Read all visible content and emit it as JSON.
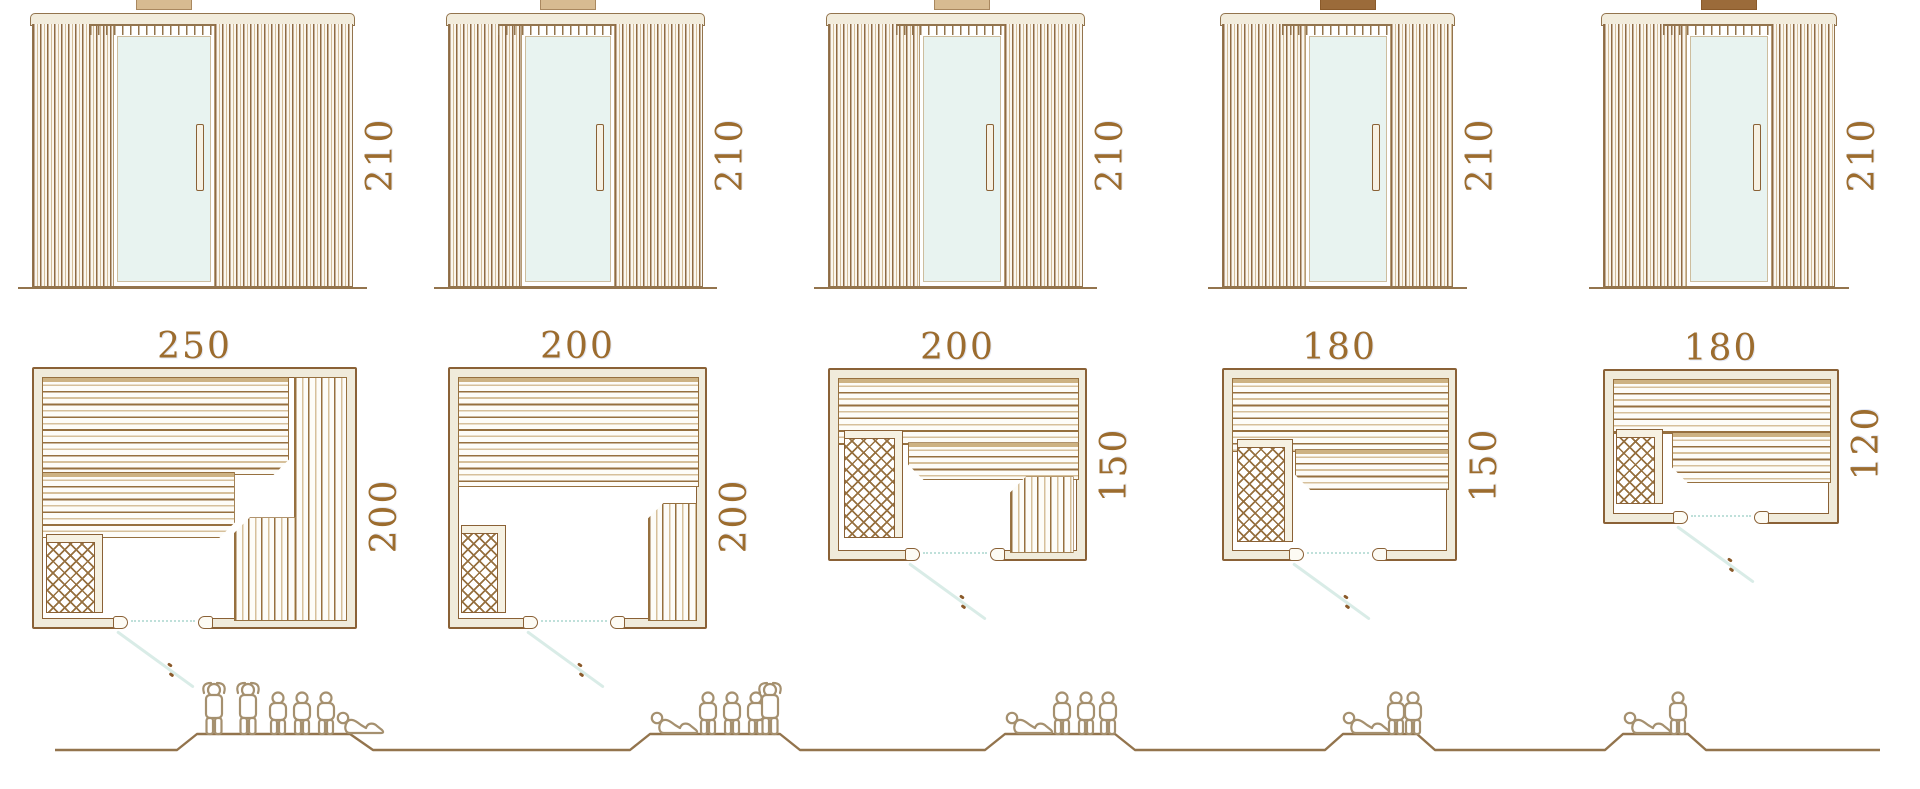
{
  "diagram_title": "Sauna cabin sizes: front elevations, floor plans and seating capacity",
  "palette": {
    "line_brown": "#93744d",
    "outline_brown": "#8a6136",
    "dimension_text": "#9c6c2e",
    "wall_fill_cream": "#f0ebdb",
    "door_glass": "#e8f3f0",
    "door_swing_teal": "#d9ece7",
    "figure_outline": "#a5906f",
    "vent_tan": "#d7bb91",
    "vent_dark": "#9b6b3a"
  },
  "models": [
    {
      "name": "sauna-250x200",
      "elevation_height": "210",
      "plan_width": "250",
      "plan_depth": "200",
      "capacity": {
        "standing": 2,
        "sitting": 3,
        "lying": 1,
        "total": 6,
        "arrangement": [
          "standing",
          "standing",
          "sitting",
          "sitting",
          "sitting",
          "lying"
        ]
      }
    },
    {
      "name": "sauna-200x200",
      "elevation_height": "210",
      "plan_width": "200",
      "plan_depth": "200",
      "capacity": {
        "standing": 1,
        "sitting": 3,
        "lying": 1,
        "total": 5,
        "arrangement": [
          "lying",
          "sitting",
          "sitting",
          "sitting",
          "standing"
        ]
      }
    },
    {
      "name": "sauna-200x150",
      "elevation_height": "210",
      "plan_width": "200",
      "plan_depth": "150",
      "capacity": {
        "standing": 0,
        "sitting": 3,
        "lying": 1,
        "total": 4,
        "arrangement": [
          "lying",
          "sitting",
          "sitting",
          "sitting"
        ]
      }
    },
    {
      "name": "sauna-180x150",
      "elevation_height": "210",
      "plan_width": "180",
      "plan_depth": "150",
      "capacity": {
        "standing": 0,
        "sitting": 2,
        "lying": 1,
        "total": 3,
        "arrangement": [
          "lying",
          "sitting",
          "sitting"
        ]
      }
    },
    {
      "name": "sauna-180x120",
      "elevation_height": "210",
      "plan_width": "180",
      "plan_depth": "120",
      "capacity": {
        "standing": 0,
        "sitting": 1,
        "lying": 1,
        "total": 2,
        "arrangement": [
          "lying",
          "sitting"
        ]
      }
    }
  ]
}
